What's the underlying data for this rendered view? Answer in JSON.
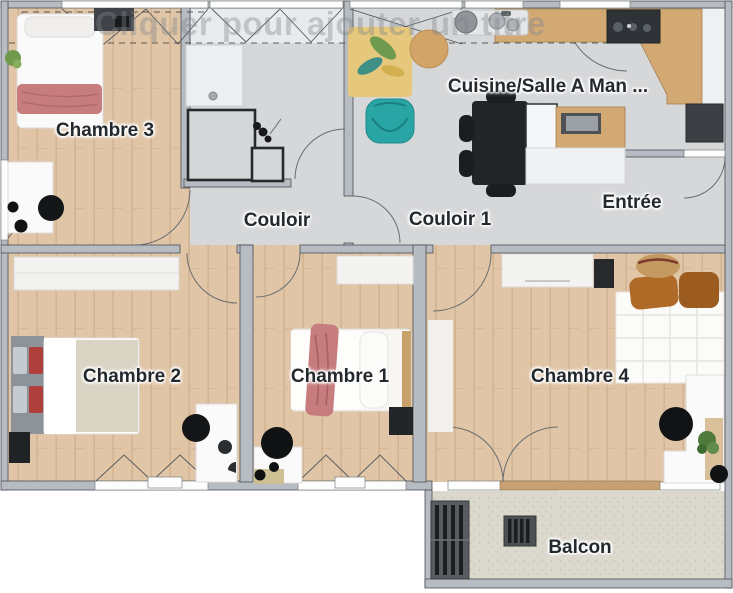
{
  "app": {
    "watermark": "Cliquer pour ajouter un titre"
  },
  "floorplan": {
    "rooms": [
      {
        "name": "chambre-3",
        "label": "Chambre 3"
      },
      {
        "name": "couloir",
        "label": "Couloir"
      },
      {
        "name": "couloir-1",
        "label": "Couloir 1"
      },
      {
        "name": "cuisine-salle-a-manger",
        "label": "Cuisine/Salle A Man ..."
      },
      {
        "name": "entree",
        "label": "Entrée"
      },
      {
        "name": "chambre-2",
        "label": "Chambre 2"
      },
      {
        "name": "chambre-1",
        "label": "Chambre 1"
      },
      {
        "name": "chambre-4",
        "label": "Chambre 4"
      },
      {
        "name": "balcon",
        "label": "Balcon"
      }
    ],
    "colors": {
      "wood-floor": "#e0c5a6",
      "tile-floor": "#d6d7d9",
      "balcony-floor": "#dbd8cd",
      "wall": "#b6bcc2",
      "wall-edge": "#4a4f54",
      "counter-wood": "#d2a873",
      "appliance-dark": "#33373b",
      "teal-armchair": "#2aa5a5",
      "red-blanket": "#c77c7e",
      "red-pillow": "#ae3f3c",
      "orange-pillow": "#b06a28",
      "label-text": "#24292e"
    }
  }
}
